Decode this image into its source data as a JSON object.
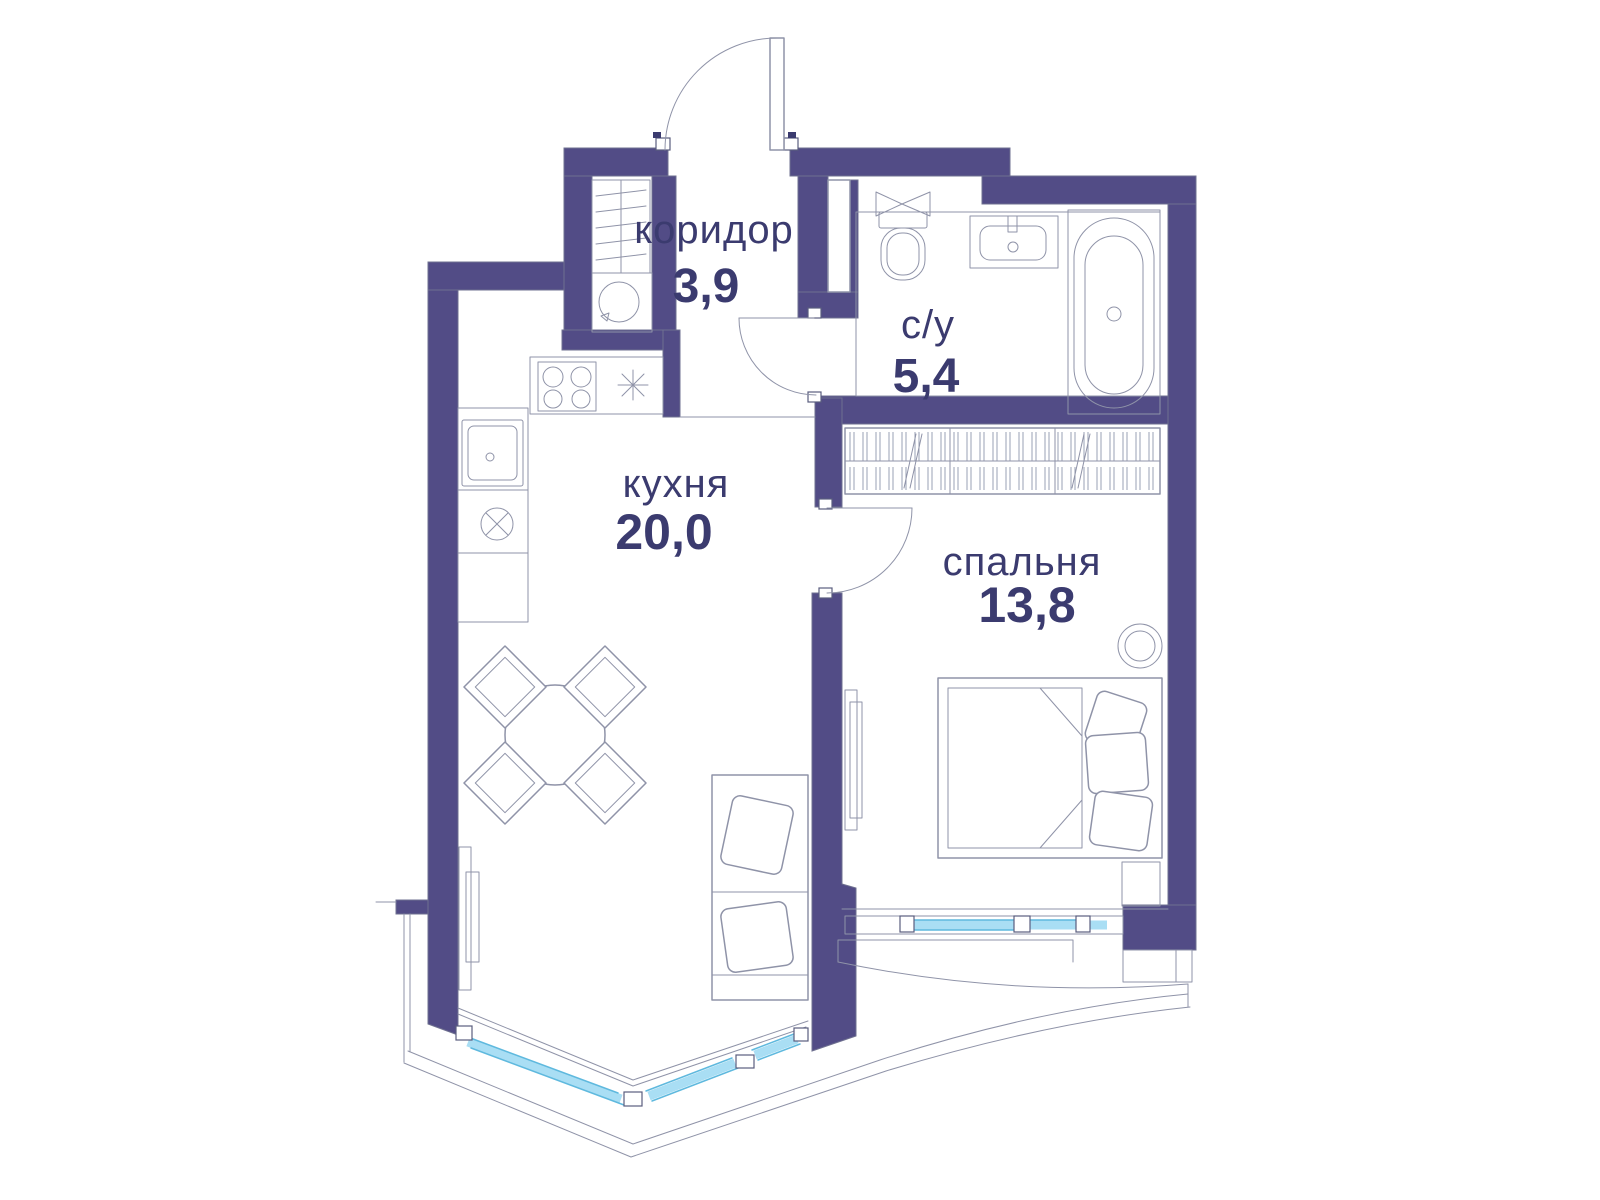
{
  "plan": {
    "type": "apartment-floor-plan",
    "language": "ru",
    "rooms": [
      {
        "id": "corridor",
        "name": "коридор",
        "area": "3,9"
      },
      {
        "id": "bathroom",
        "name": "с/у",
        "area": "5,4"
      },
      {
        "id": "kitchen",
        "name": "кухня",
        "area": "20,0"
      },
      {
        "id": "bedroom",
        "name": "спальня",
        "area": "13,8"
      }
    ],
    "fixtures": [
      "entry-door-icon",
      "interior-door-icon",
      "closet-shelves-icon",
      "washing-machine-icon",
      "kitchen-sink-icon",
      "cooktop-icon",
      "light-symbol-icon",
      "shaft-icon",
      "vent-fan-icon",
      "toilet-icon",
      "washbasin-icon",
      "bathtub-icon",
      "wardrobe-icon",
      "double-bed-icon",
      "pillow-icon",
      "floor-lamp-icon",
      "nightstand-icon",
      "dining-table-icon",
      "chair-icon",
      "sofa-icon",
      "radiator-icon",
      "panoramic-window-icon",
      "bedroom-window-icon"
    ]
  },
  "colors": {
    "wall": "#524c86",
    "outline": "#6f7190",
    "furniture_line": "#8f93a8",
    "window_glass": "#a9def4",
    "window_edge": "#5fb9de",
    "label_text": "#3b3b6f",
    "background": "#ffffff"
  }
}
